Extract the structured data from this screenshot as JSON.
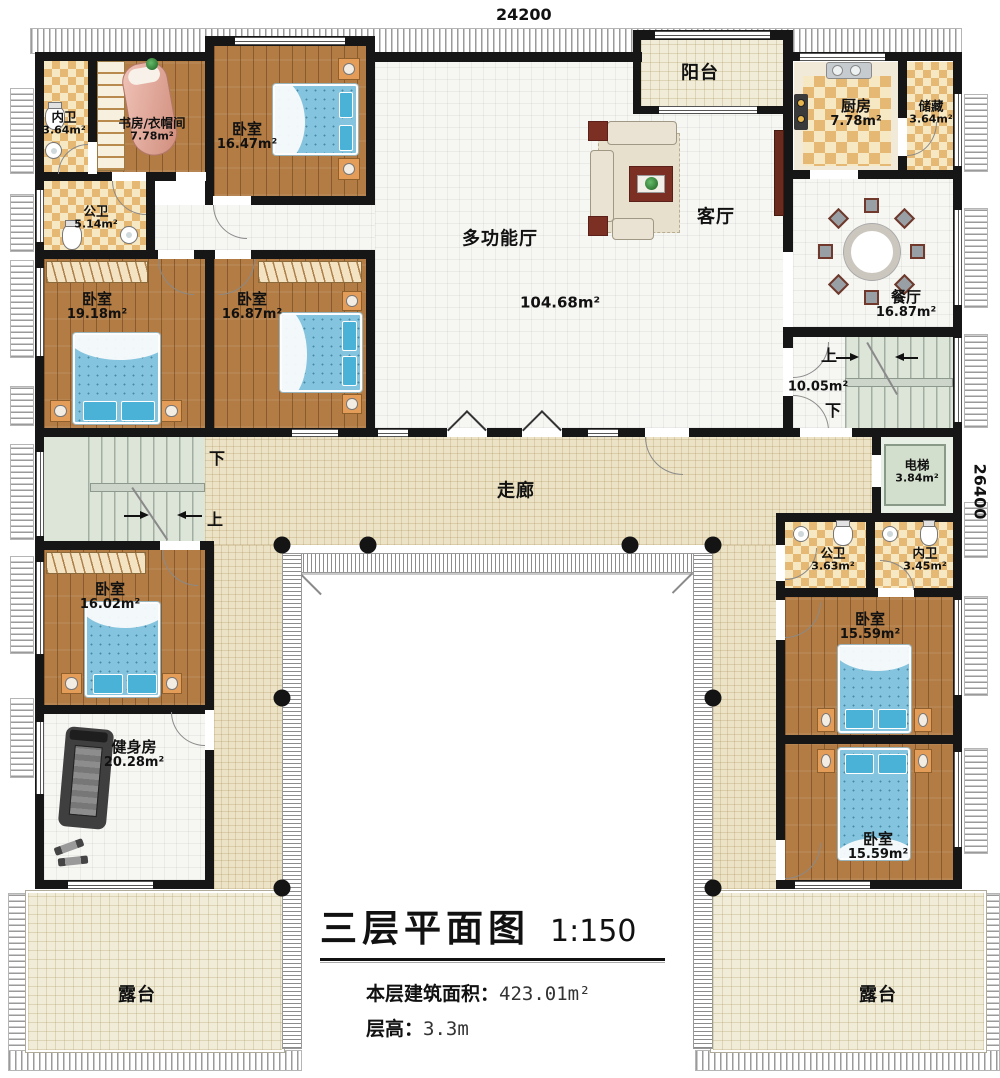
{
  "dimensions": {
    "top": "24200",
    "right": "26400"
  },
  "title": {
    "main": "三层平面图",
    "scale": "1:150",
    "area_label": "本层建筑面积：",
    "area_value": "423.01m²",
    "floor_height_label": "层高：",
    "floor_height_value": "3.3m"
  },
  "rooms": {
    "bath_top_left": {
      "name": "内卫",
      "area": "3.64m²"
    },
    "study": {
      "name": "书房/衣帽间",
      "area": "7.78m²"
    },
    "bedroom_1647": {
      "name": "卧室",
      "area": "16.47m²"
    },
    "public_bath_514": {
      "name": "公卫",
      "area": "5.14m²"
    },
    "bedroom_1918": {
      "name": "卧室",
      "area": "19.18m²"
    },
    "bedroom_1687": {
      "name": "卧室",
      "area": "16.87m²"
    },
    "hall": {
      "name": "多功能厅",
      "area": "104.68m²"
    },
    "balcony": {
      "name": "阳台"
    },
    "living": {
      "name": "客厅"
    },
    "kitchen": {
      "name": "厨房",
      "area": "7.78m²"
    },
    "storage": {
      "name": "储藏",
      "area": "3.64m²"
    },
    "dining": {
      "name": "餐厅",
      "area": "16.87m²"
    },
    "stair_right": {
      "up": "上",
      "down": "下",
      "area": "10.05m²"
    },
    "elevator": {
      "name": "电梯",
      "area": "3.84m²"
    },
    "stair_left": {
      "up": "上",
      "down": "下"
    },
    "corridor": {
      "name": "走廊"
    },
    "bedroom_1602": {
      "name": "卧室",
      "area": "16.02m²"
    },
    "gym": {
      "name": "健身房",
      "area": "20.28m²"
    },
    "public_bath_363": {
      "name": "公卫",
      "area": "3.63m²"
    },
    "bath_345": {
      "name": "内卫",
      "area": "3.45m²"
    },
    "bedroom_1559_a": {
      "name": "卧室",
      "area": "15.59m²"
    },
    "bedroom_1559_b": {
      "name": "卧室",
      "area": "15.59m²"
    },
    "terrace_left": {
      "name": "露台"
    },
    "terrace_right": {
      "name": "露台"
    }
  }
}
